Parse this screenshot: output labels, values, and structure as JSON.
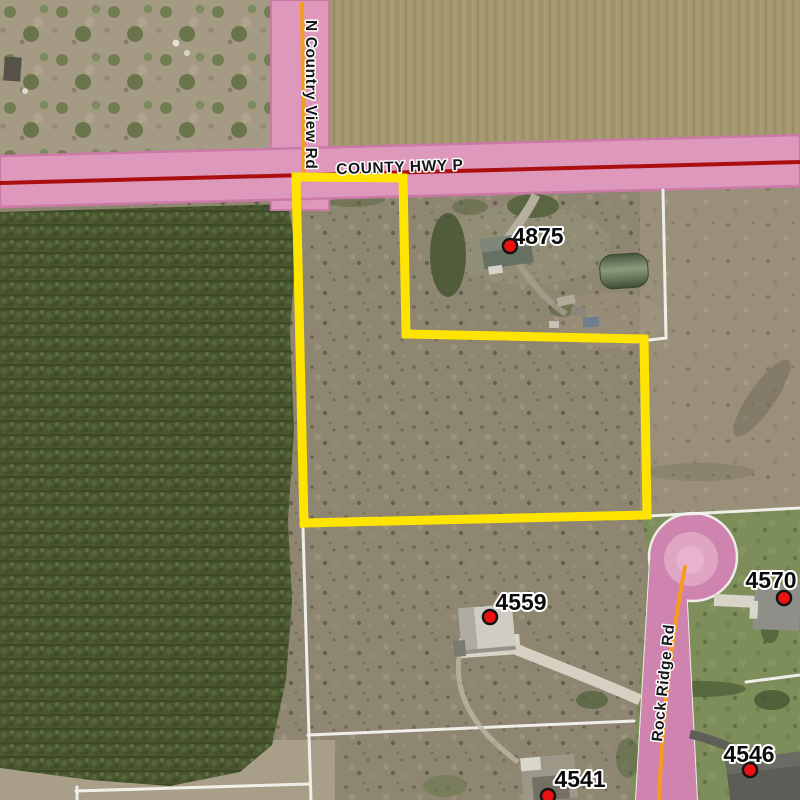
{
  "roads": {
    "county_hwy_p": {
      "label": "COUNTY HWY P"
    },
    "n_country_view_rd": {
      "label": "N Country View Rd"
    },
    "rock_ridge_rd": {
      "label": "Rock Ridge Rd"
    }
  },
  "addresses": [
    {
      "label": "4875"
    },
    {
      "label": "4559"
    },
    {
      "label": "4570"
    },
    {
      "label": "4546"
    },
    {
      "label": "4541"
    }
  ],
  "colors": {
    "road_buffer": "#dd98bc",
    "road_buffer_edge": "#cb79a7",
    "highway_centerline": "#ab0f0f",
    "street_centerline": "#f39c1e",
    "parcel_highlight": "#ffe400",
    "parcel_line": "#f4f3ef",
    "marker_dot": "#ee1111"
  }
}
